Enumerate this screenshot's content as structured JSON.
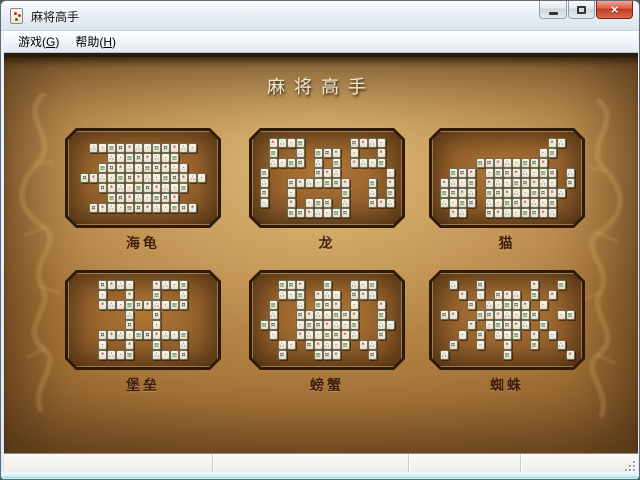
{
  "window": {
    "title": "麻将高手",
    "controls": {
      "close_glyph": "×"
    }
  },
  "menu": {
    "items": [
      {
        "pre": "游戏(",
        "key": "G",
        "post": ")"
      },
      {
        "pre": "帮助(",
        "key": "H",
        "post": ")"
      }
    ]
  },
  "main": {
    "heading": "麻将高手",
    "layouts": [
      {
        "name": "turtle",
        "label": "海龟",
        "map": [
          ".############.",
          "...########...",
          "..##########..",
          "##############",
          "..##########..",
          "...########...",
          ".############."
        ]
      },
      {
        "name": "dragon",
        "label": "龙",
        "map": [
          ".####.....####.",
          ".#..#.###.#..#.",
          ".####.#.#.####.",
          "#.....###.....#",
          "#..#######..#.#",
          "#..#.....#..#.#",
          "#..#.###.#..###",
          "...#######....."
        ]
      },
      {
        "name": "cat",
        "label": "猫",
        "map": [
          "............##.",
          "...........##..",
          "....########...",
          ".###.########.#",
          "####.########.#",
          "####.#########.",
          "####.########..",
          ".##..########.."
        ]
      },
      {
        "name": "fortress",
        "label": "堡垒",
        "map": [
          "..####..####..",
          "..#..#..#..#..",
          "..##########..",
          ".....#..#.....",
          ".....#..#.....",
          "..##########..",
          "..#..#..#..#..",
          "..####..####.."
        ]
      },
      {
        "name": "crab",
        "label": "螃蟹",
        "map": [
          "..###..#..###..",
          "..###.###.###..",
          ".#..#.###.#..#.",
          ".#..#######..#.",
          "##..#######..##",
          ".#..#######..#.",
          "..##.#####.##..",
          "..#...###...#.."
        ]
      },
      {
        "name": "spider",
        "label": "蜘蛛",
        "map": [
          ".#..#.....#..#.",
          "..#.#.###.#.#..",
          "...#.#####.#...",
          "##..#######..##",
          "...#.#####.#...",
          "..#.#.###.#.#..",
          ".#..#..#..#..#.",
          "#......#......#"
        ]
      }
    ]
  },
  "tiles": {
    "glyphs": [
      "*",
      "≡",
      "∴",
      "¤",
      "·"
    ],
    "colors": [
      "#9e2b25",
      "#2d6a30",
      "#27418c",
      "#3a3a3a",
      "#8a2b6b"
    ]
  },
  "statusbar": {
    "panes": [
      "",
      "",
      "",
      ""
    ]
  },
  "colors": {
    "parchment_center": "#c79a58",
    "parchment_edge": "#4a2f12",
    "plaque_border": "#2e1a08",
    "label_text": "#401d0c",
    "heading_text": "#f2e9cf",
    "close_button_red": "#bf3a20",
    "titlebar_glass": "#eaf0f6"
  }
}
